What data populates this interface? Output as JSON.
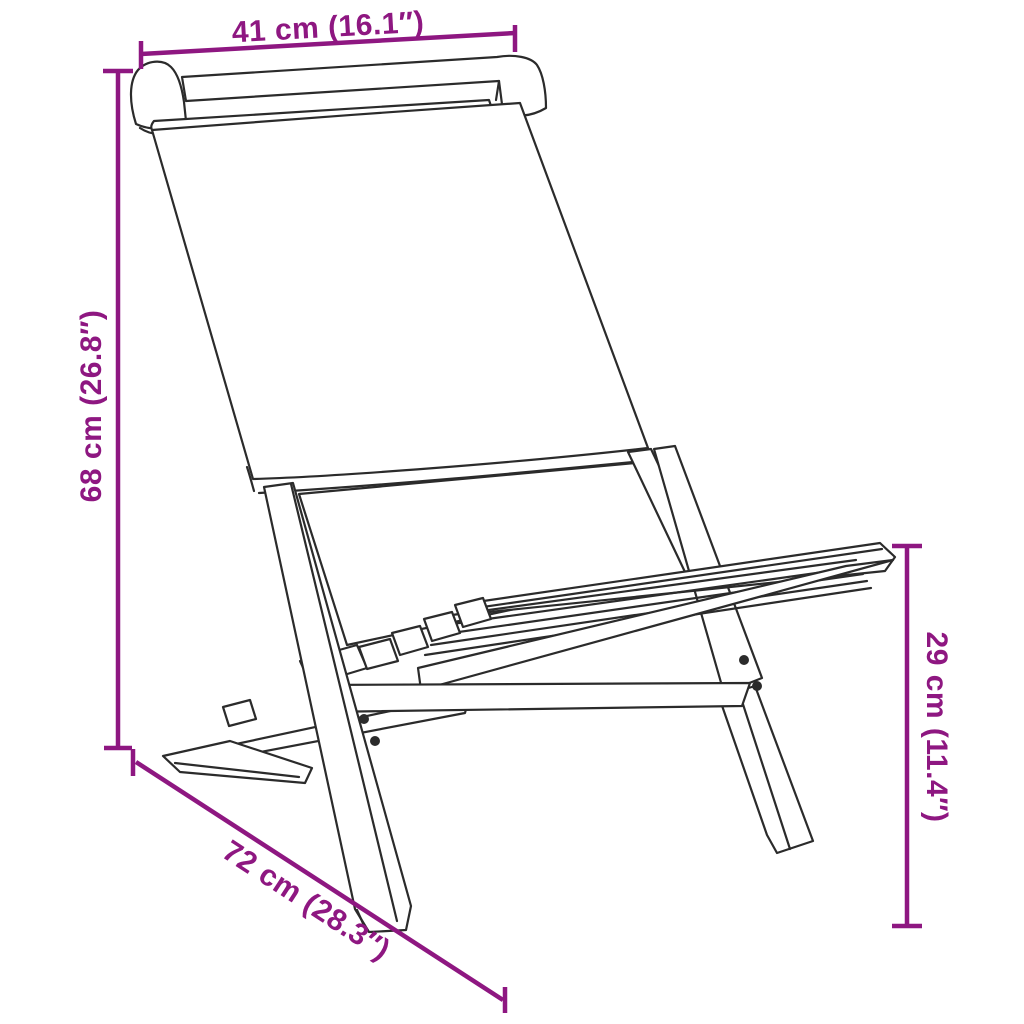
{
  "diagram": {
    "subject": "folding chair with fabric back and slatted wooden seat",
    "style": "black outline product drawing with purple dimension lines",
    "accent_color": "#8E1781",
    "outline_color": "#2b2b2b",
    "background_color": "#ffffff",
    "dimensions": [
      {
        "id": "top-width",
        "label": "41 cm (16.1″)",
        "cm": 41,
        "inches": 16.1,
        "position": "top"
      },
      {
        "id": "left-height",
        "label": "68 cm (26.8″)",
        "cm": 68,
        "inches": 26.8,
        "position": "left"
      },
      {
        "id": "bottom-depth",
        "label": "72 cm (28.3″)",
        "cm": 72,
        "inches": 28.3,
        "position": "bottom-diagonal"
      },
      {
        "id": "right-seat-height",
        "label": "29 cm (11.4″)",
        "cm": 29,
        "inches": 11.4,
        "position": "right"
      }
    ]
  }
}
